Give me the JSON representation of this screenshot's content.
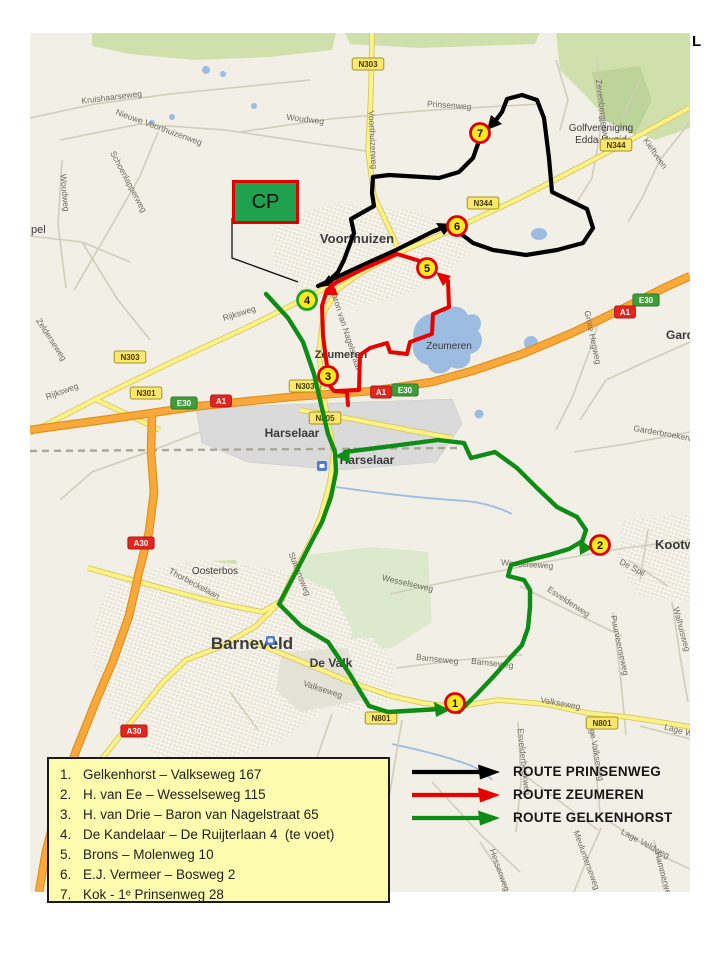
{
  "frame": {
    "corner_mark": "L"
  },
  "cp_box": {
    "label": "CP"
  },
  "site_legend": {
    "items": [
      {
        "num": "1.",
        "label": "Gelkenhorst – Valkseweg 167"
      },
      {
        "num": "2.",
        "label": "H. van Ee – Wesselseweg 115"
      },
      {
        "num": "3.",
        "label": "H. van Drie – Baron van Nagelstraat 65"
      },
      {
        "num": "4.",
        "label": "De Kandelaar – De Ruijterlaan 4  (te voet)"
      },
      {
        "num": "5.",
        "label": "Brons – Molenweg 10"
      },
      {
        "num": "6.",
        "label": "E.J. Vermeer – Bosweg 2"
      },
      {
        "num": "7.",
        "label": "Kok - 1ᵉ Prinsenweg 28"
      }
    ]
  },
  "route_legend": {
    "items": [
      {
        "id": "prinsenweg",
        "label": "ROUTE PRINSENWEG",
        "color": "#000000"
      },
      {
        "id": "zeumeren",
        "label": "ROUTE ZEUMEREN",
        "color": "#e60000"
      },
      {
        "id": "gelkenhorst",
        "label": "ROUTE GELKENHORST",
        "color": "#0e8c15"
      }
    ]
  },
  "markers": [
    {
      "num": "1",
      "x": 455,
      "y": 703,
      "ring": "#e10000"
    },
    {
      "num": "2",
      "x": 600,
      "y": 545,
      "ring": "#e10000"
    },
    {
      "num": "3",
      "x": 328,
      "y": 376,
      "ring": "#e10000"
    },
    {
      "num": "4",
      "x": 307,
      "y": 300,
      "ring": "#1fa01f"
    },
    {
      "num": "5",
      "x": 427,
      "y": 268,
      "ring": "#e10000"
    },
    {
      "num": "6",
      "x": 457,
      "y": 226,
      "ring": "#e10000"
    },
    {
      "num": "7",
      "x": 480,
      "y": 133,
      "ring": "#e10000"
    }
  ],
  "map": {
    "towns": [
      {
        "t": "Voorthuizen",
        "x": 357,
        "y": 243,
        "s": 13,
        "b": 1
      },
      {
        "t": "Zeumeren",
        "x": 341,
        "y": 358,
        "s": 11,
        "b": 1
      },
      {
        "t": "Zeumeren",
        "x": 449,
        "y": 349,
        "s": 10,
        "b": 0
      },
      {
        "t": "Harselaar",
        "x": 292,
        "y": 437,
        "s": 12,
        "b": 1
      },
      {
        "t": "Harselaar",
        "x": 367,
        "y": 464,
        "s": 12,
        "b": 1
      },
      {
        "t": "Barneveld",
        "x": 252,
        "y": 649,
        "s": 17,
        "b": 1
      },
      {
        "t": "De Valk",
        "x": 331,
        "y": 667,
        "s": 12,
        "b": 1
      },
      {
        "t": "Oosterbos",
        "x": 215,
        "y": 574,
        "s": 10,
        "b": 0
      },
      {
        "t": "Kootwijkerbroek",
        "x": 655,
        "y": 549,
        "s": 13,
        "b": 1,
        "a": "start"
      },
      {
        "t": "Garderen",
        "x": 666,
        "y": 339,
        "s": 12,
        "b": 1,
        "a": "start"
      },
      {
        "t": "Golfvereniging",
        "x": 601,
        "y": 131,
        "s": 10,
        "b": 0
      },
      {
        "t": "Edda Huzid",
        "x": 601,
        "y": 143,
        "s": 10,
        "b": 0
      },
      {
        "t": "pel",
        "x": 31,
        "y": 233,
        "s": 11,
        "b": 0,
        "a": "start"
      }
    ],
    "street_labels": [
      {
        "t": "Kruishaarseweg",
        "x": 112,
        "y": 100,
        "r": -7
      },
      {
        "t": "Nieuwe Voorthuizenweg",
        "x": 158,
        "y": 130,
        "r": 20
      },
      {
        "t": "Woudweg",
        "x": 305,
        "y": 122,
        "r": 7
      },
      {
        "t": "Woudweg",
        "x": 62,
        "y": 193,
        "r": 85
      },
      {
        "t": "Schoenlapperweg",
        "x": 126,
        "y": 183,
        "r": 62
      },
      {
        "t": "Prinsenweg",
        "x": 449,
        "y": 108,
        "r": 4
      },
      {
        "t": "Voorthuizerweg",
        "x": 370,
        "y": 140,
        "r": 87
      },
      {
        "t": "Zevenbergjesweg",
        "x": 600,
        "y": 113,
        "r": 83
      },
      {
        "t": "Kieftveen",
        "x": 653,
        "y": 155,
        "r": 55
      },
      {
        "t": "Rijksweg",
        "x": 240,
        "y": 316,
        "r": -17
      },
      {
        "t": "Rijksweg",
        "x": 63,
        "y": 394,
        "r": -20
      },
      {
        "t": "Zelderseweg",
        "x": 49,
        "y": 341,
        "r": 57
      },
      {
        "t": "Baron van Nagelstraat",
        "x": 343,
        "y": 330,
        "r": 72
      },
      {
        "t": "Grote Hegweg",
        "x": 590,
        "y": 338,
        "r": 78
      },
      {
        "t": "Garderbroekerweg",
        "x": 668,
        "y": 437,
        "r": 10
      },
      {
        "t": "Thorbeckelaan",
        "x": 193,
        "y": 586,
        "r": 28
      },
      {
        "t": "Stationsweg",
        "x": 297,
        "y": 575,
        "r": 68
      },
      {
        "t": "Wesselseweg",
        "x": 407,
        "y": 586,
        "r": 13
      },
      {
        "t": "Wesselseweg",
        "x": 527,
        "y": 567,
        "r": 4
      },
      {
        "t": "Esvelderweg",
        "x": 567,
        "y": 604,
        "r": 33
      },
      {
        "t": "De Spil",
        "x": 631,
        "y": 570,
        "r": 28
      },
      {
        "t": "Puurveenseweg",
        "x": 617,
        "y": 646,
        "r": 78
      },
      {
        "t": "Walhuisweg",
        "x": 679,
        "y": 630,
        "r": 75
      },
      {
        "t": "Barnseweg",
        "x": 437,
        "y": 662,
        "r": 6
      },
      {
        "t": "Barnseweg",
        "x": 492,
        "y": 666,
        "r": 6
      },
      {
        "t": "Valkseweg",
        "x": 322,
        "y": 692,
        "r": 18
      },
      {
        "t": "Valkseweg",
        "x": 560,
        "y": 706,
        "r": 10
      },
      {
        "t": "Hoge Valkseweg",
        "x": 593,
        "y": 750,
        "r": 80
      },
      {
        "t": "Esvelderbeekweg",
        "x": 521,
        "y": 762,
        "r": 84
      },
      {
        "t": "Meulunterseweg",
        "x": 584,
        "y": 861,
        "r": 70
      },
      {
        "t": "Lage Veldweg",
        "x": 644,
        "y": 846,
        "r": 28
      },
      {
        "t": "Hammerweg",
        "x": 661,
        "y": 876,
        "r": 75
      },
      {
        "t": "Hessenweg",
        "x": 497,
        "y": 871,
        "r": 70
      },
      {
        "t": "Lage W",
        "x": 678,
        "y": 733,
        "r": 15
      }
    ],
    "shields": [
      {
        "t": "N303",
        "x": 368,
        "y": 64,
        "k": "n"
      },
      {
        "t": "N303",
        "x": 130,
        "y": 357,
        "k": "n"
      },
      {
        "t": "N301",
        "x": 146,
        "y": 393,
        "k": "n"
      },
      {
        "t": "N344",
        "x": 483,
        "y": 203,
        "k": "n"
      },
      {
        "t": "N344",
        "x": 616,
        "y": 145,
        "k": "n"
      },
      {
        "t": "N303",
        "x": 305,
        "y": 386,
        "k": "n"
      },
      {
        "t": "N805",
        "x": 325,
        "y": 418,
        "k": "n"
      },
      {
        "t": "E30",
        "x": 184,
        "y": 403,
        "k": "e"
      },
      {
        "t": "A1",
        "x": 221,
        "y": 401,
        "k": "a"
      },
      {
        "t": "A1",
        "x": 381,
        "y": 392,
        "k": "a"
      },
      {
        "t": "E30",
        "x": 405,
        "y": 390,
        "k": "e"
      },
      {
        "t": "E30",
        "x": 646,
        "y": 300,
        "k": "e"
      },
      {
        "t": "A1",
        "x": 625,
        "y": 312,
        "k": "a"
      },
      {
        "t": "A30",
        "x": 141,
        "y": 543,
        "k": "a"
      },
      {
        "t": "A30",
        "x": 134,
        "y": 731,
        "k": "a"
      },
      {
        "t": "N801",
        "x": 381,
        "y": 718,
        "k": "n"
      },
      {
        "t": "N801",
        "x": 602,
        "y": 723,
        "k": "n"
      }
    ]
  }
}
